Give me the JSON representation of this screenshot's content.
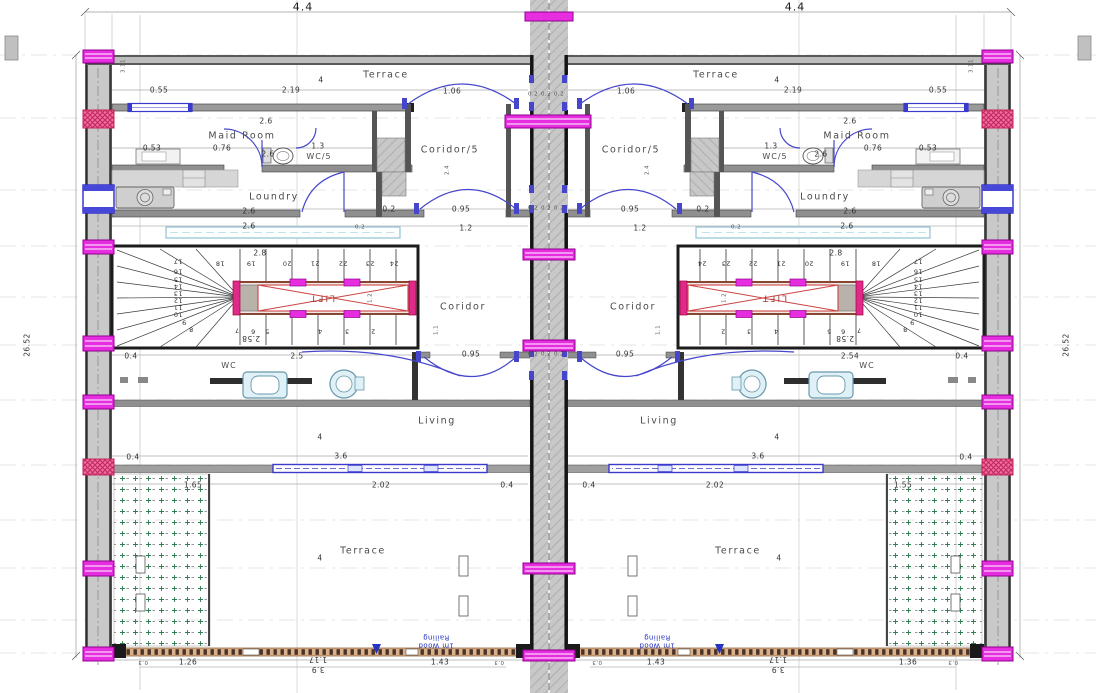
{
  "meta": {
    "drawing_type": "architectural floor plan, two mirrored residential units with central shaft",
    "rooms_per_unit": [
      "Terrace",
      "Maid Room",
      "WC/5",
      "Coridor/5",
      "Loundry",
      "Coridor",
      "WC",
      "Living",
      "Terrace"
    ],
    "stair_steps": "2 to 24",
    "lift_label": "LIFT",
    "railing_note": "1m Wood Railing",
    "unit_width_dim": "4.4",
    "total_height_dim": "26.52"
  },
  "colors": {
    "magenta_column": "#e62ee0",
    "red_hatch_column": "#ef6fa0",
    "door_window_blue": "#4646cc",
    "fixture_blue": "#dff0f6",
    "lift_red": "#cc3333",
    "railing_tan": "#d9b08c",
    "planter_green": "#2e7d52",
    "wall_gray": "#c9c9c9"
  },
  "texts": [
    {
      "t": "4.4",
      "x": 303,
      "y": 7,
      "c": "d9",
      "n": "dim-unit-width-left"
    },
    {
      "t": "4.4",
      "x": 795,
      "y": 7,
      "c": "d9",
      "n": "dim-unit-width-right"
    },
    {
      "t": "26.52",
      "x": 27,
      "y": 345,
      "c": "d v",
      "n": "dim-total-height-left"
    },
    {
      "t": "26.52",
      "x": 1066,
      "y": 345,
      "c": "d v",
      "n": "dim-total-height-right"
    },
    {
      "t": "Terrace",
      "x": 386,
      "y": 75,
      "c": "r",
      "n": "room-label-terrace-top-left"
    },
    {
      "t": "4",
      "x": 321,
      "y": 80,
      "c": "d"
    },
    {
      "t": "Terrace",
      "x": 716,
      "y": 75,
      "c": "r",
      "n": "room-label-terrace-top-right"
    },
    {
      "t": "4",
      "x": 777,
      "y": 80,
      "c": "d"
    },
    {
      "t": "0.55",
      "x": 159,
      "y": 90,
      "c": "d"
    },
    {
      "t": "2.19",
      "x": 291,
      "y": 90,
      "c": "d"
    },
    {
      "t": "1.06",
      "x": 452,
      "y": 91,
      "c": "d"
    },
    {
      "t": "1.06",
      "x": 626,
      "y": 91,
      "c": "d"
    },
    {
      "t": "2.19",
      "x": 793,
      "y": 90,
      "c": "d"
    },
    {
      "t": "0.55",
      "x": 938,
      "y": 90,
      "c": "d"
    },
    {
      "t": "0.2",
      "x": 533,
      "y": 95,
      "c": "t"
    },
    {
      "t": "0.2",
      "x": 546,
      "y": 95,
      "c": "t"
    },
    {
      "t": "0.2",
      "x": 559,
      "y": 95,
      "c": "t"
    },
    {
      "t": "3.11",
      "x": 124,
      "y": 66,
      "c": "t v"
    },
    {
      "t": "3.11",
      "x": 972,
      "y": 66,
      "c": "t v"
    },
    {
      "t": "2.6",
      "x": 266,
      "y": 121,
      "c": "d"
    },
    {
      "t": "2.6",
      "x": 850,
      "y": 121,
      "c": "d"
    },
    {
      "t": "Maid Room",
      "x": 242,
      "y": 136,
      "c": "r",
      "n": "room-label-maid-room-left"
    },
    {
      "t": "Maid Room",
      "x": 857,
      "y": 136,
      "c": "r",
      "n": "room-label-maid-room-right"
    },
    {
      "t": "0.53",
      "x": 152,
      "y": 148,
      "c": "d"
    },
    {
      "t": "0.76",
      "x": 222,
      "y": 148,
      "c": "d"
    },
    {
      "t": "2.6",
      "x": 268,
      "y": 154,
      "c": "d"
    },
    {
      "t": "1.3",
      "x": 318,
      "y": 146,
      "c": "d"
    },
    {
      "t": "1.3",
      "x": 771,
      "y": 146,
      "c": "d"
    },
    {
      "t": "2.6",
      "x": 821,
      "y": 154,
      "c": "d"
    },
    {
      "t": "0.76",
      "x": 873,
      "y": 148,
      "c": "d"
    },
    {
      "t": "0.53",
      "x": 928,
      "y": 148,
      "c": "d"
    },
    {
      "t": "WC/5",
      "x": 319,
      "y": 157,
      "c": "rs",
      "n": "room-label-wc5-left"
    },
    {
      "t": "WC/5",
      "x": 775,
      "y": 157,
      "c": "rs",
      "n": "room-label-wc5-right"
    },
    {
      "t": "Coridor/5",
      "x": 450,
      "y": 150,
      "c": "r",
      "n": "room-label-coridor5-left"
    },
    {
      "t": "Coridor/5",
      "x": 631,
      "y": 150,
      "c": "r",
      "n": "room-label-coridor5-right"
    },
    {
      "t": "2.4",
      "x": 448,
      "y": 170,
      "c": "t v"
    },
    {
      "t": "2.4",
      "x": 648,
      "y": 170,
      "c": "t v"
    },
    {
      "t": "Loundry",
      "x": 274,
      "y": 197,
      "c": "r",
      "n": "room-label-loundry-left"
    },
    {
      "t": "Loundry",
      "x": 825,
      "y": 197,
      "c": "r",
      "n": "room-label-loundry-right"
    },
    {
      "t": "2.6",
      "x": 249,
      "y": 211,
      "c": "d"
    },
    {
      "t": "2.6",
      "x": 850,
      "y": 211,
      "c": "d"
    },
    {
      "t": "0.2",
      "x": 389,
      "y": 209,
      "c": "d"
    },
    {
      "t": "0.95",
      "x": 461,
      "y": 209,
      "c": "d"
    },
    {
      "t": "0.95",
      "x": 630,
      "y": 209,
      "c": "d"
    },
    {
      "t": "0.2",
      "x": 703,
      "y": 209,
      "c": "d"
    },
    {
      "t": "0.2",
      "x": 533,
      "y": 209,
      "c": "t"
    },
    {
      "t": "0.2",
      "x": 546,
      "y": 209,
      "c": "t"
    },
    {
      "t": "0.2",
      "x": 559,
      "y": 209,
      "c": "t"
    },
    {
      "t": "2.6",
      "x": 249,
      "y": 226,
      "c": "d"
    },
    {
      "t": "0.2",
      "x": 360,
      "y": 228,
      "c": "t"
    },
    {
      "t": "1.2",
      "x": 466,
      "y": 228,
      "c": "d"
    },
    {
      "t": "1.2",
      "x": 640,
      "y": 228,
      "c": "d"
    },
    {
      "t": "0.2",
      "x": 736,
      "y": 228,
      "c": "t"
    },
    {
      "t": "2.6",
      "x": 847,
      "y": 226,
      "c": "d"
    },
    {
      "t": "2.8",
      "x": 260,
      "y": 253,
      "c": "d"
    },
    {
      "t": "2.8",
      "x": 836,
      "y": 253,
      "c": "d"
    },
    {
      "t": "18",
      "x": 220,
      "y": 263,
      "c": "st"
    },
    {
      "t": "19",
      "x": 251,
      "y": 263,
      "c": "st"
    },
    {
      "t": "20",
      "x": 287,
      "y": 263,
      "c": "st"
    },
    {
      "t": "21",
      "x": 315,
      "y": 263,
      "c": "st"
    },
    {
      "t": "22",
      "x": 343,
      "y": 263,
      "c": "st"
    },
    {
      "t": "23",
      "x": 370,
      "y": 263,
      "c": "st"
    },
    {
      "t": "24",
      "x": 394,
      "y": 263,
      "c": "st"
    },
    {
      "t": "18",
      "x": 876,
      "y": 263,
      "c": "st"
    },
    {
      "t": "19",
      "x": 845,
      "y": 263,
      "c": "st"
    },
    {
      "t": "20",
      "x": 809,
      "y": 263,
      "c": "st"
    },
    {
      "t": "21",
      "x": 781,
      "y": 263,
      "c": "st"
    },
    {
      "t": "22",
      "x": 753,
      "y": 263,
      "c": "st"
    },
    {
      "t": "23",
      "x": 726,
      "y": 263,
      "c": "st"
    },
    {
      "t": "24",
      "x": 702,
      "y": 263,
      "c": "st"
    },
    {
      "t": "17",
      "x": 178,
      "y": 261,
      "c": "st"
    },
    {
      "t": "16",
      "x": 178,
      "y": 271,
      "c": "st"
    },
    {
      "t": "15",
      "x": 178,
      "y": 279,
      "c": "st"
    },
    {
      "t": "14",
      "x": 178,
      "y": 286,
      "c": "st"
    },
    {
      "t": "13",
      "x": 178,
      "y": 293,
      "c": "st"
    },
    {
      "t": "12",
      "x": 178,
      "y": 300,
      "c": "st"
    },
    {
      "t": "11",
      "x": 178,
      "y": 307,
      "c": "st"
    },
    {
      "t": "10",
      "x": 178,
      "y": 314,
      "c": "st"
    },
    {
      "t": "9",
      "x": 184,
      "y": 322,
      "c": "st"
    },
    {
      "t": "8",
      "x": 191,
      "y": 329,
      "c": "st"
    },
    {
      "t": "17",
      "x": 918,
      "y": 261,
      "c": "st"
    },
    {
      "t": "16",
      "x": 918,
      "y": 271,
      "c": "st"
    },
    {
      "t": "15",
      "x": 918,
      "y": 279,
      "c": "st"
    },
    {
      "t": "14",
      "x": 918,
      "y": 286,
      "c": "st"
    },
    {
      "t": "13",
      "x": 918,
      "y": 293,
      "c": "st"
    },
    {
      "t": "12",
      "x": 918,
      "y": 300,
      "c": "st"
    },
    {
      "t": "11",
      "x": 918,
      "y": 307,
      "c": "st"
    },
    {
      "t": "10",
      "x": 918,
      "y": 314,
      "c": "st"
    },
    {
      "t": "9",
      "x": 912,
      "y": 322,
      "c": "st"
    },
    {
      "t": "8",
      "x": 905,
      "y": 329,
      "c": "st"
    },
    {
      "t": "7",
      "x": 237,
      "y": 330,
      "c": "st"
    },
    {
      "t": "6",
      "x": 253,
      "y": 331,
      "c": "st"
    },
    {
      "t": "5",
      "x": 267,
      "y": 331,
      "c": "st"
    },
    {
      "t": "4",
      "x": 320,
      "y": 331,
      "c": "st"
    },
    {
      "t": "3",
      "x": 347,
      "y": 331,
      "c": "st"
    },
    {
      "t": "2",
      "x": 373,
      "y": 331,
      "c": "st"
    },
    {
      "t": "7",
      "x": 859,
      "y": 330,
      "c": "st"
    },
    {
      "t": "6",
      "x": 843,
      "y": 331,
      "c": "st"
    },
    {
      "t": "5",
      "x": 829,
      "y": 331,
      "c": "st"
    },
    {
      "t": "4",
      "x": 776,
      "y": 331,
      "c": "st"
    },
    {
      "t": "3",
      "x": 749,
      "y": 331,
      "c": "st"
    },
    {
      "t": "2",
      "x": 723,
      "y": 331,
      "c": "st"
    },
    {
      "t": "2.58",
      "x": 251,
      "y": 338,
      "c": "d f"
    },
    {
      "t": "2.58",
      "x": 845,
      "y": 338,
      "c": "d f"
    },
    {
      "t": "LIFT",
      "x": 322,
      "y": 297,
      "c": "lift",
      "n": "lift-label-left"
    },
    {
      "t": "LIFT",
      "x": 774,
      "y": 297,
      "c": "lift",
      "n": "lift-label-right"
    },
    {
      "t": "1.2",
      "x": 371,
      "y": 298,
      "c": "t v"
    },
    {
      "t": "1.2",
      "x": 725,
      "y": 298,
      "c": "t v"
    },
    {
      "t": "Coridor",
      "x": 463,
      "y": 307,
      "c": "r",
      "n": "room-label-coridor-left"
    },
    {
      "t": "Coridor",
      "x": 633,
      "y": 307,
      "c": "r",
      "n": "room-label-coridor-right"
    },
    {
      "t": "1.1",
      "x": 437,
      "y": 330,
      "c": "t v"
    },
    {
      "t": "1.1",
      "x": 659,
      "y": 330,
      "c": "t v"
    },
    {
      "t": "0.4",
      "x": 131,
      "y": 356,
      "c": "d"
    },
    {
      "t": "2.5",
      "x": 297,
      "y": 356,
      "c": "d"
    },
    {
      "t": "0.95",
      "x": 471,
      "y": 354,
      "c": "d"
    },
    {
      "t": "0.95",
      "x": 625,
      "y": 354,
      "c": "d"
    },
    {
      "t": "2.54",
      "x": 850,
      "y": 356,
      "c": "d"
    },
    {
      "t": "0.4",
      "x": 962,
      "y": 356,
      "c": "d"
    },
    {
      "t": "0.2",
      "x": 533,
      "y": 355,
      "c": "t"
    },
    {
      "t": "0.2",
      "x": 546,
      "y": 355,
      "c": "t"
    },
    {
      "t": "0.2",
      "x": 559,
      "y": 355,
      "c": "t"
    },
    {
      "t": "WC",
      "x": 229,
      "y": 366,
      "c": "rs",
      "n": "room-label-wc-left"
    },
    {
      "t": "WC",
      "x": 867,
      "y": 366,
      "c": "rs",
      "n": "room-label-wc-right"
    },
    {
      "t": "Living",
      "x": 437,
      "y": 421,
      "c": "r",
      "n": "room-label-living-left"
    },
    {
      "t": "4",
      "x": 320,
      "y": 437,
      "c": "d"
    },
    {
      "t": "Living",
      "x": 659,
      "y": 421,
      "c": "r",
      "n": "room-label-living-right"
    },
    {
      "t": "4",
      "x": 777,
      "y": 437,
      "c": "d"
    },
    {
      "t": "0.4",
      "x": 133,
      "y": 457,
      "c": "d"
    },
    {
      "t": "3.6",
      "x": 341,
      "y": 456,
      "c": "d"
    },
    {
      "t": "3.6",
      "x": 758,
      "y": 456,
      "c": "d"
    },
    {
      "t": "0.4",
      "x": 966,
      "y": 457,
      "c": "d"
    },
    {
      "t": "1.65",
      "x": 193,
      "y": 485,
      "c": "d"
    },
    {
      "t": "2.02",
      "x": 381,
      "y": 485,
      "c": "d"
    },
    {
      "t": "0.4",
      "x": 507,
      "y": 485,
      "c": "d"
    },
    {
      "t": "0.4",
      "x": 589,
      "y": 485,
      "c": "d"
    },
    {
      "t": "2.02",
      "x": 715,
      "y": 485,
      "c": "d"
    },
    {
      "t": "1.55",
      "x": 903,
      "y": 485,
      "c": "d"
    },
    {
      "t": "Terrace",
      "x": 363,
      "y": 551,
      "c": "r",
      "n": "room-label-terrace-bottom-left"
    },
    {
      "t": "4",
      "x": 320,
      "y": 558,
      "c": "d"
    },
    {
      "t": "Terrace",
      "x": 738,
      "y": 551,
      "c": "r",
      "n": "room-label-terrace-bottom-right"
    },
    {
      "t": "4",
      "x": 779,
      "y": 558,
      "c": "d"
    },
    {
      "t": "1m Wood Railing",
      "x": 436,
      "y": 641,
      "c": "note",
      "n": "railing-note-left"
    },
    {
      "t": "1m Wood Railing",
      "x": 657,
      "y": 641,
      "c": "note",
      "n": "railing-note-right"
    },
    {
      "t": "1.26",
      "x": 188,
      "y": 662,
      "c": "d"
    },
    {
      "t": "1.17",
      "x": 318,
      "y": 659,
      "c": "d f"
    },
    {
      "t": "3.9",
      "x": 318,
      "y": 669,
      "c": "d f"
    },
    {
      "t": "1.43",
      "x": 440,
      "y": 662,
      "c": "d"
    },
    {
      "t": "1.43",
      "x": 656,
      "y": 662,
      "c": "d"
    },
    {
      "t": "1.17",
      "x": 778,
      "y": 659,
      "c": "d f"
    },
    {
      "t": "3.9",
      "x": 778,
      "y": 669,
      "c": "d f"
    },
    {
      "t": "1.36",
      "x": 908,
      "y": 662,
      "c": "d"
    },
    {
      "t": "0.3",
      "x": 143,
      "y": 661,
      "c": "t f"
    },
    {
      "t": "0.3",
      "x": 499,
      "y": 661,
      "c": "t f"
    },
    {
      "t": "0.3",
      "x": 597,
      "y": 661,
      "c": "t f"
    },
    {
      "t": "0.3",
      "x": 953,
      "y": 661,
      "c": "t f"
    }
  ]
}
